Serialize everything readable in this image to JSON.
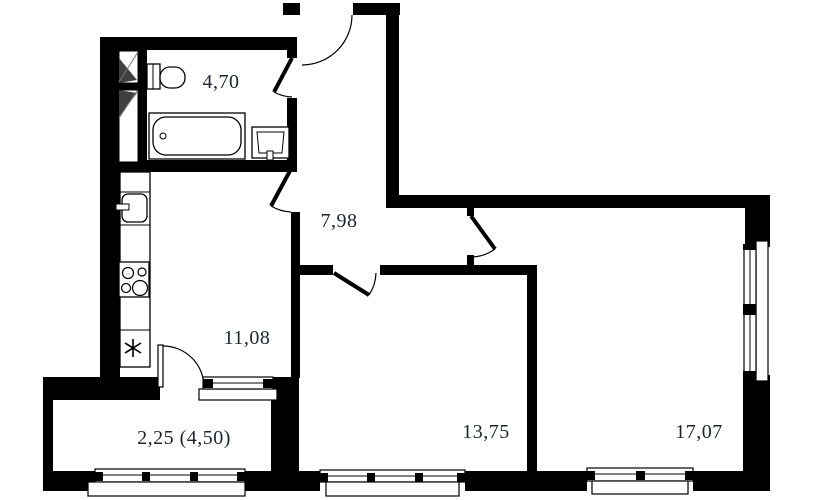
{
  "plan": {
    "kind": "apartment-floor-plan",
    "colors": {
      "wall": "#000000",
      "background": "#ffffff",
      "label_text": "#1c2333"
    },
    "rooms": [
      {
        "id": "bathroom",
        "area_label": "4,70"
      },
      {
        "id": "hallway",
        "area_label": "7,98"
      },
      {
        "id": "kitchen",
        "area_label": "11,08"
      },
      {
        "id": "room-1",
        "area_label": "13,75"
      },
      {
        "id": "room-2",
        "area_label": "17,07"
      },
      {
        "id": "balcony",
        "area_label": "2,25 (4,50)"
      }
    ],
    "fixtures": [
      {
        "icon": "toilet-icon",
        "room": "bathroom"
      },
      {
        "icon": "bathtub-icon",
        "room": "bathroom"
      },
      {
        "icon": "washbasin-icon",
        "room": "bathroom"
      },
      {
        "icon": "vent-shaft-icon",
        "room": "bathroom"
      },
      {
        "icon": "vent-shaft-icon",
        "room": "bathroom"
      },
      {
        "icon": "kitchen-sink-icon",
        "room": "kitchen"
      },
      {
        "icon": "stove-icon",
        "room": "kitchen"
      },
      {
        "icon": "star-symbol-icon",
        "room": "kitchen"
      }
    ],
    "openings": {
      "doors": [
        "entrance-door",
        "bathroom-door",
        "kitchen-door",
        "room-1-door",
        "room-2-door",
        "balcony-door"
      ],
      "windows": [
        "kitchen-window",
        "balcony-glazing",
        "room-1-window",
        "room-2-window",
        "room-2-side-window"
      ]
    }
  }
}
